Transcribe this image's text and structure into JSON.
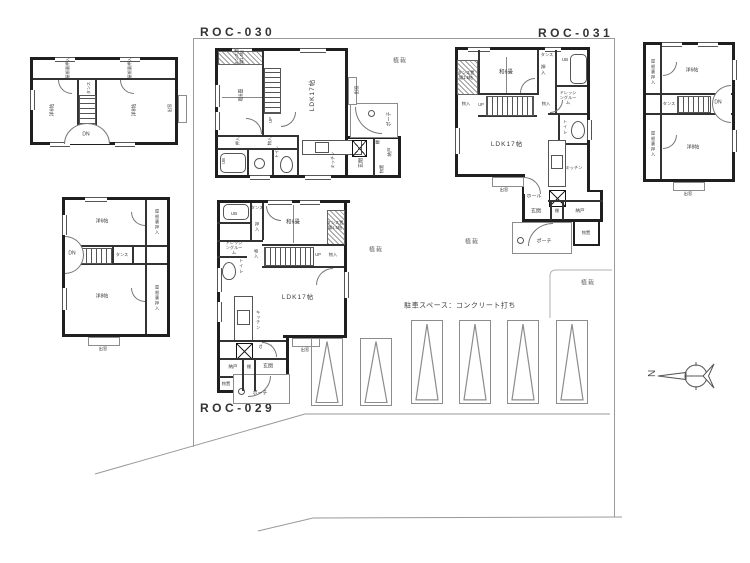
{
  "titles": {
    "roc030": "ROC-030",
    "roc031": "ROC-031",
    "roc029": "ROC-029"
  },
  "t": {
    "ldk": "LDK17帖",
    "washitsu": "和6畳",
    "tansu_space": "タンス置場1.5帖",
    "tansu": "タンス",
    "oshiire": "押入",
    "monoiri": "物入",
    "ub": "UB",
    "senmen": "洗面",
    "dressing": "ドレッシングルーム",
    "toilet": "トイレ",
    "kitchen": "キッチン",
    "hall": "ホール",
    "genkan": "玄関",
    "tana": "棚",
    "nando": "納戸",
    "monooki": "物置",
    "porch": "ポーチ",
    "demado": "出窓",
    "up": "UP",
    "dn": "DN",
    "yaneura": "屋根裏押入",
    "yo6": "洋6帖",
    "yo8": "洋8帖",
    "plant": "植栽",
    "parking_note": "駐車スペース：コンクリート打ち",
    "north": "N"
  },
  "colors": {
    "wall": "#1f1f1f",
    "line": "#9a9a9a",
    "text": "#3a3a3a"
  }
}
